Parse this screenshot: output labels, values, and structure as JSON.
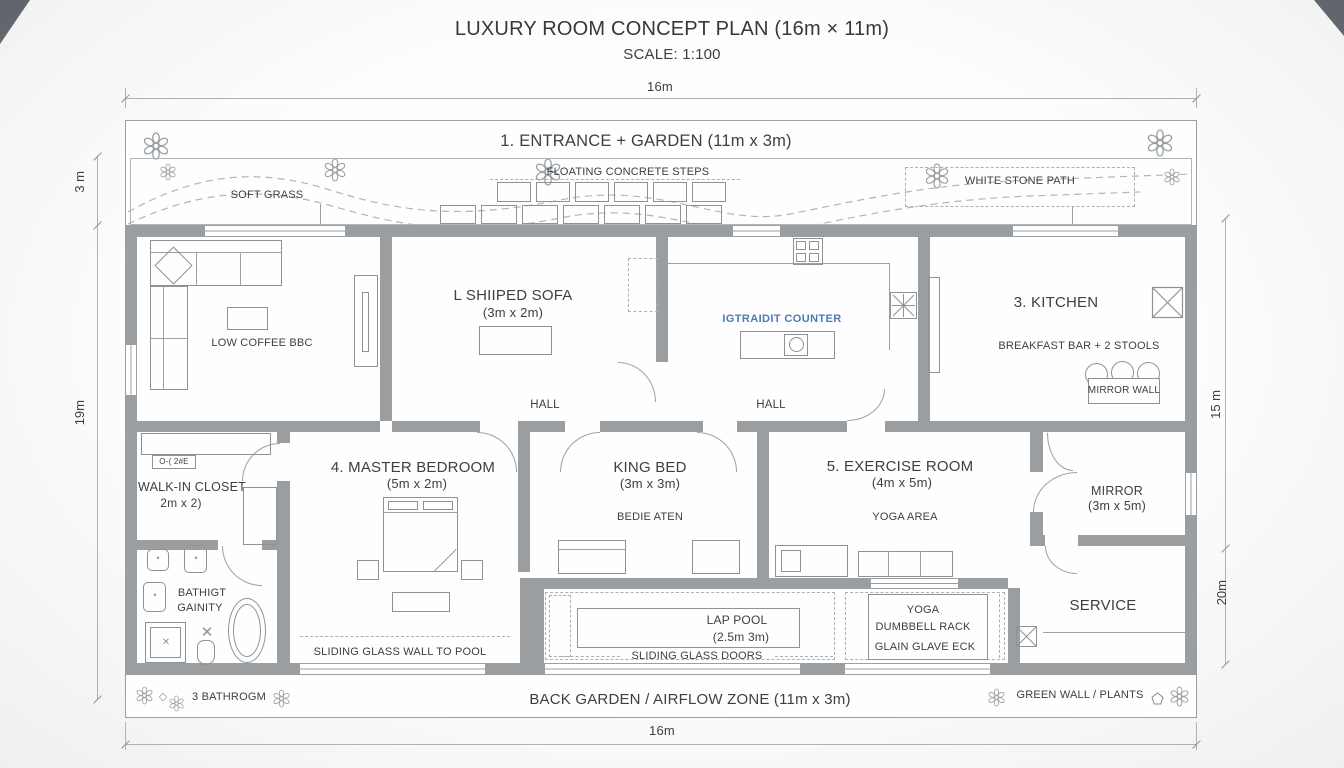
{
  "header": {
    "title": "LUXURY ROOM CONCEPT PLAN (16m × 11m)",
    "subtitle": "SCALE: 1:100"
  },
  "dimensions": {
    "top": "16m",
    "bottom": "16m",
    "left_upper": "3 m",
    "left_lower": "19m",
    "right_upper": "15 m",
    "right_lower": "20m"
  },
  "front_garden": {
    "title": "1. ENTRANCE + GARDEN (11m x 3m)",
    "grass": "SOFT GRASS",
    "steps": "FLOATING CONCRETE STEPS",
    "path": "WHITE STONE PATH"
  },
  "living_room": {
    "coffee_table": "LOW COFFEE BBC"
  },
  "sofa_room": {
    "title": "L SHIIPED SOFA",
    "size": "(3m x 2m)"
  },
  "kitchen": {
    "island": "IGTRAIDIT COUNTER",
    "title": "3. KITCHEN",
    "breakfast_bar": "BREAKFAST BAR + 2 STOOLS",
    "mirror_wall": "MIRROR WALL"
  },
  "halls": {
    "left": "HALL",
    "right": "HALL"
  },
  "closet": {
    "tag": "O-( 2#E",
    "title": "WALK-IN CLOSET",
    "size": "2m x 2)"
  },
  "bathroom": {
    "line1": "BATHIGT",
    "line2": "GAINITY",
    "bottom_tag": "3 BATHROGM"
  },
  "master_bedroom": {
    "title": "4. MASTER BEDROOM",
    "size": "(5m x 2m)",
    "note": "SLIDING GLASS WALL TO POOL"
  },
  "king_room": {
    "title": "KING BED",
    "size": "(3m x 3m)",
    "note": "BEDIE ATEN"
  },
  "exercise_room": {
    "title": "5. EXERCISE ROOM",
    "size": "(4m x 5m)",
    "note": "YOGA AREA"
  },
  "mirror_room": {
    "title": "MIRROR",
    "size": "(3m x 5m)"
  },
  "pool": {
    "title": "LAP POOL",
    "size": "(2.5m 3m)",
    "doors": "SLIDING GLASS DOORS"
  },
  "rack": {
    "line1": "YOGA",
    "line2": "DUMBBELL RACK",
    "line3": "GLAIN GLAVE ECK"
  },
  "service_room": {
    "title": "SERVICE"
  },
  "back_garden": {
    "title": "BACK GARDEN / AIRFLOW ZONE (11m x 3m)",
    "green_wall": "GREEN WALL / PLANTS"
  },
  "icons": {
    "diamond_glyph": "◇",
    "cross_glyph": "✕"
  },
  "colors": {
    "wall": "#9b9ea1",
    "line": "#8f9295",
    "text": "#3c4043",
    "island_blue": "#4e7ab5"
  }
}
